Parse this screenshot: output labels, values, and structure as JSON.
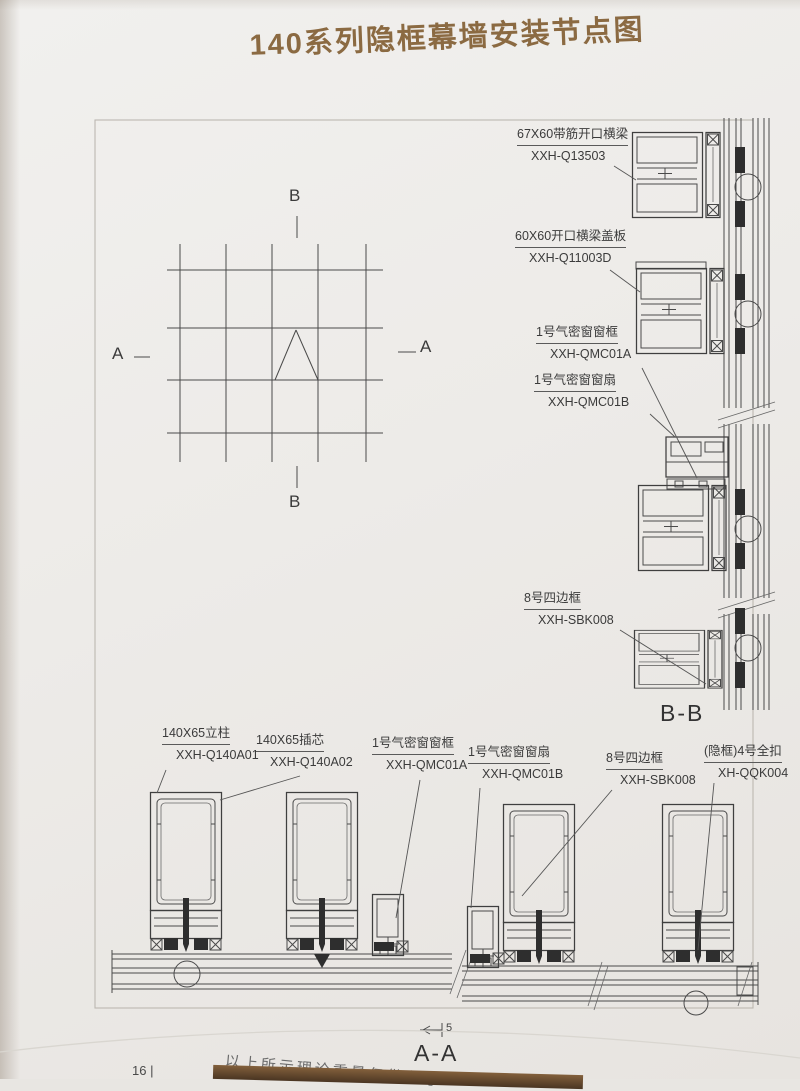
{
  "page": {
    "title": "140系列隐框幕墙安装节点图",
    "page_number": "16 |",
    "footer_note": "以上所示理论重量仅供参考"
  },
  "colors": {
    "title_brown": "#8b6a42",
    "drawing_line": "#4a4a4a",
    "accent_bar": "#6b4a2f"
  },
  "elevation": {
    "marker_top": "B",
    "marker_bottom": "B",
    "marker_left": "A",
    "marker_right": "A"
  },
  "section_bb": {
    "title": "B-B",
    "parts": [
      {
        "name": "67X60带筋开口横梁",
        "code": "XXH-Q13503"
      },
      {
        "name": "60X60开口横梁盖板",
        "code": "XXH-Q11003D"
      },
      {
        "name": "1号气密窗窗框",
        "code": "XXH-QMC01A"
      },
      {
        "name": "1号气密窗窗扇",
        "code": "XXH-QMC01B"
      },
      {
        "name": "8号四边框",
        "code": "XXH-SBK008"
      }
    ]
  },
  "section_aa": {
    "title": "A-A",
    "dimension": "5",
    "parts": [
      {
        "name": "140X65立柱",
        "code": "XXH-Q140A01"
      },
      {
        "name": "140X65插芯",
        "code": "XXH-Q140A02"
      },
      {
        "name": "1号气密窗窗框",
        "code": "XXH-QMC01A"
      },
      {
        "name": "1号气密窗窗扇",
        "code": "XXH-QMC01B"
      },
      {
        "name": "8号四边框",
        "code": "XXH-SBK008"
      },
      {
        "name": "(隐框)4号全扣",
        "code": "XH-QQK004"
      }
    ]
  }
}
